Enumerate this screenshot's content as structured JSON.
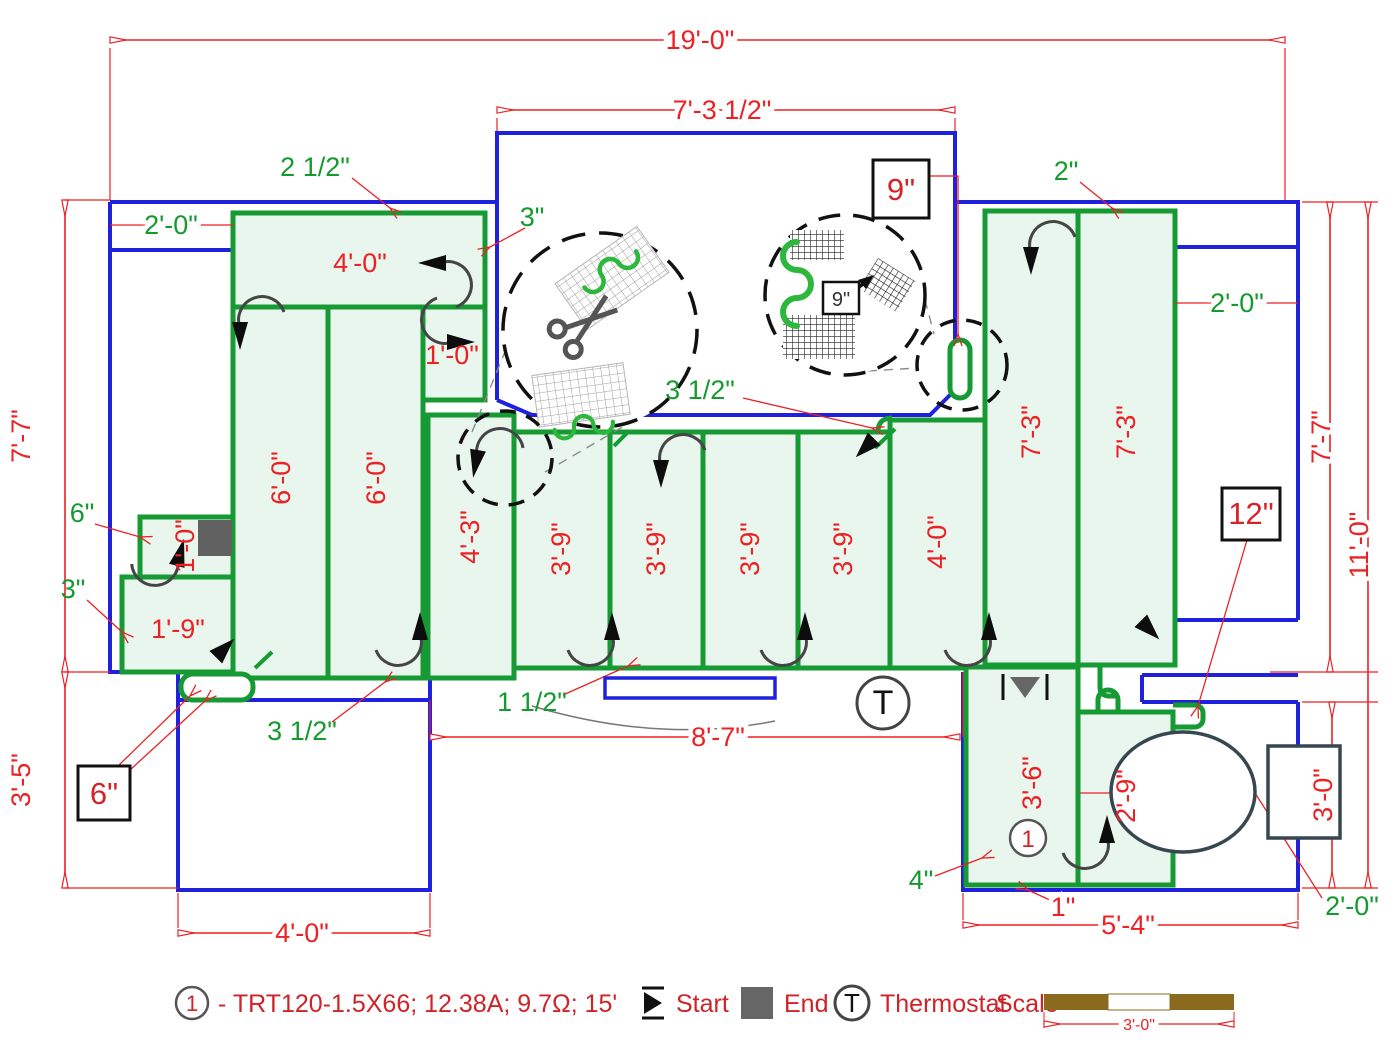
{
  "drawing_type": "electric radiant floor heating mat layout plan",
  "colors": {
    "wall": "#2021dd",
    "mat_border": "#169a33",
    "mat_fill": "#e9f6ee",
    "dimension_red": "#ed2024",
    "offset_green": "#149a2e",
    "scale_bar_brown": "#8a6b1d",
    "end_symbol_gray": "#616161"
  },
  "labels": {
    "d19": "19'-0\"",
    "d73half": "7'-3 1/2\"",
    "d77": "7'-7\"",
    "d35": "3'-5\"",
    "d110": "11'-0\"",
    "d30": "3'-0\"",
    "d87": "8'-7\"",
    "d40": "4'-0\"",
    "d54": "5'-4\"",
    "m60": "6'-0\"",
    "m10": "1'-0\"",
    "m43": "4'-3\"",
    "m39": "3'-9\"",
    "m73": "7'-3\"",
    "m36": "3'-6\"",
    "m29": "2'-9\"",
    "m19": "1'-9\"",
    "g25": "2 1/2\"",
    "g3": "3\"",
    "g20": "2'-0\"",
    "g2": "2\"",
    "g35": "3 1/2\"",
    "g6": "6\"",
    "g15": "1 1/2\"",
    "g4": "4\"",
    "r1": "1\"",
    "c9": "9\"",
    "c12": "12\"",
    "c6": "6\"",
    "mat_id": "1"
  },
  "legend": {
    "mat_id": "1",
    "spec": "- TRT120-1.5X66; 12.38A; 9.7Ω; 15'",
    "start": "Start",
    "end": "End",
    "thermostat": "Thermostat",
    "thermo_symbol": "T",
    "scale": "Scale",
    "scale_length": "3'-0\""
  }
}
